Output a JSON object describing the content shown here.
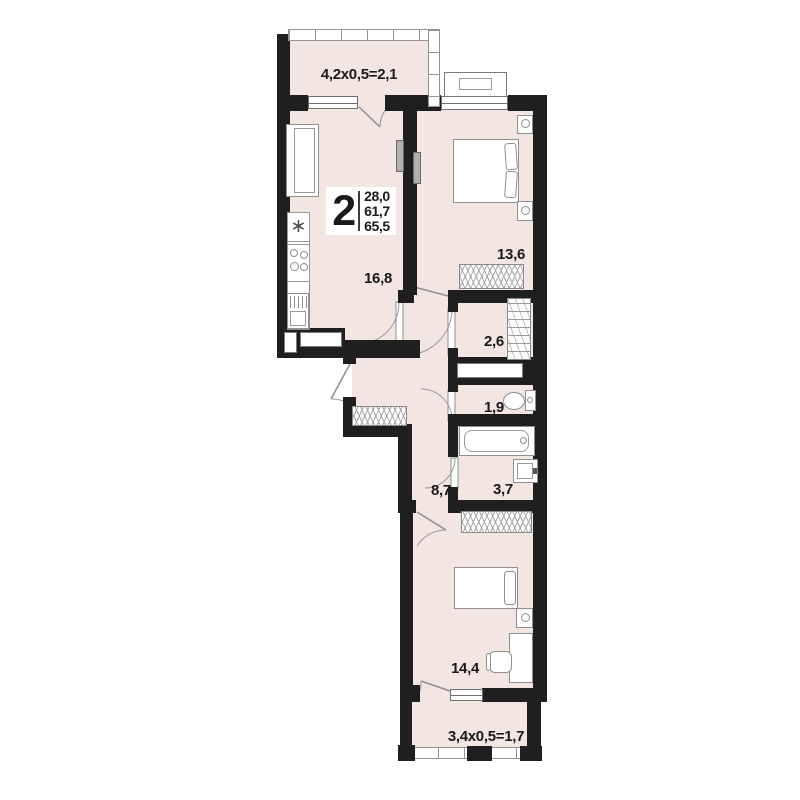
{
  "floor_plan": {
    "unit_badge": {
      "rooms": "2",
      "areas": [
        "28,0",
        "61,7",
        "65,5"
      ]
    },
    "labels": {
      "balcony_top": "4,2х0,5=2,1",
      "kitchen_living": "16,8",
      "bedroom_1": "13,6",
      "closet": "2,6",
      "wc": "1,9",
      "hallway": "8,7",
      "bathroom": "3,7",
      "bedroom_2": "14,4",
      "balcony_bottom": "3,4х0,5=1,7"
    },
    "icons": {
      "sink": "∗"
    },
    "colors": {
      "wall": "#1f1f1f",
      "floor": "#f2e5e2",
      "line": "#8f8f8f",
      "background": "#ffffff",
      "text": "#1a1a1a"
    }
  }
}
